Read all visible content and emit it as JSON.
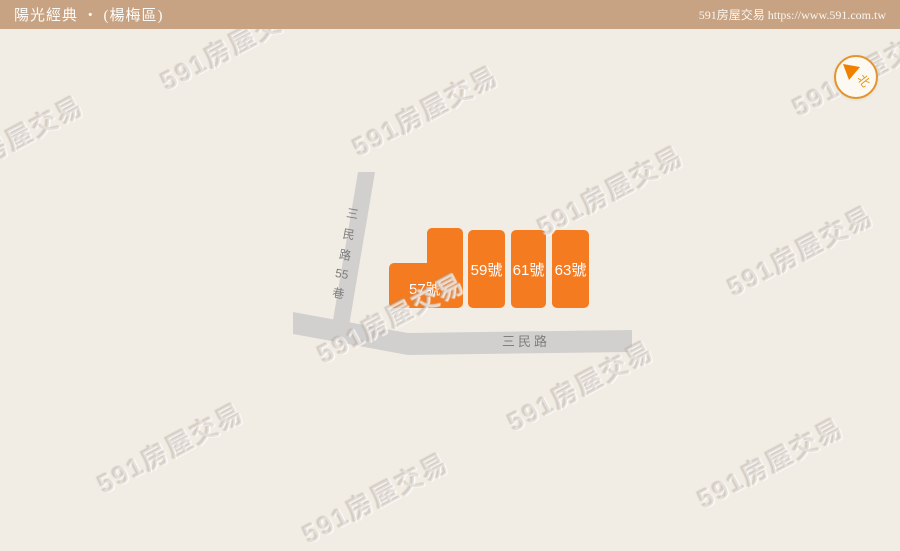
{
  "header": {
    "title": "陽光經典 ‧ (楊梅區)",
    "site": "591房屋交易 https://www.591.com.tw"
  },
  "map": {
    "lane": {
      "name": "三民路55巷",
      "chars": [
        "三",
        "民",
        "路",
        "55",
        "巷"
      ]
    },
    "main_road": {
      "name": "三民路"
    },
    "buildings": [
      {
        "label": "57號"
      },
      {
        "label": "59號"
      },
      {
        "label": "61號"
      },
      {
        "label": "63號"
      }
    ],
    "compass": {
      "north": "北"
    }
  },
  "watermark": {
    "text": "591房屋交易"
  },
  "colors": {
    "header_bg": "#c7a383",
    "map_bg": "#f2ede4",
    "road": "#d2d0ce",
    "road_text": "#7e7e7e",
    "building_orange": "#f47b1f",
    "building_text": "#ffffff",
    "compass_ring": "#e2952d",
    "compass_orange": "#f08100"
  }
}
